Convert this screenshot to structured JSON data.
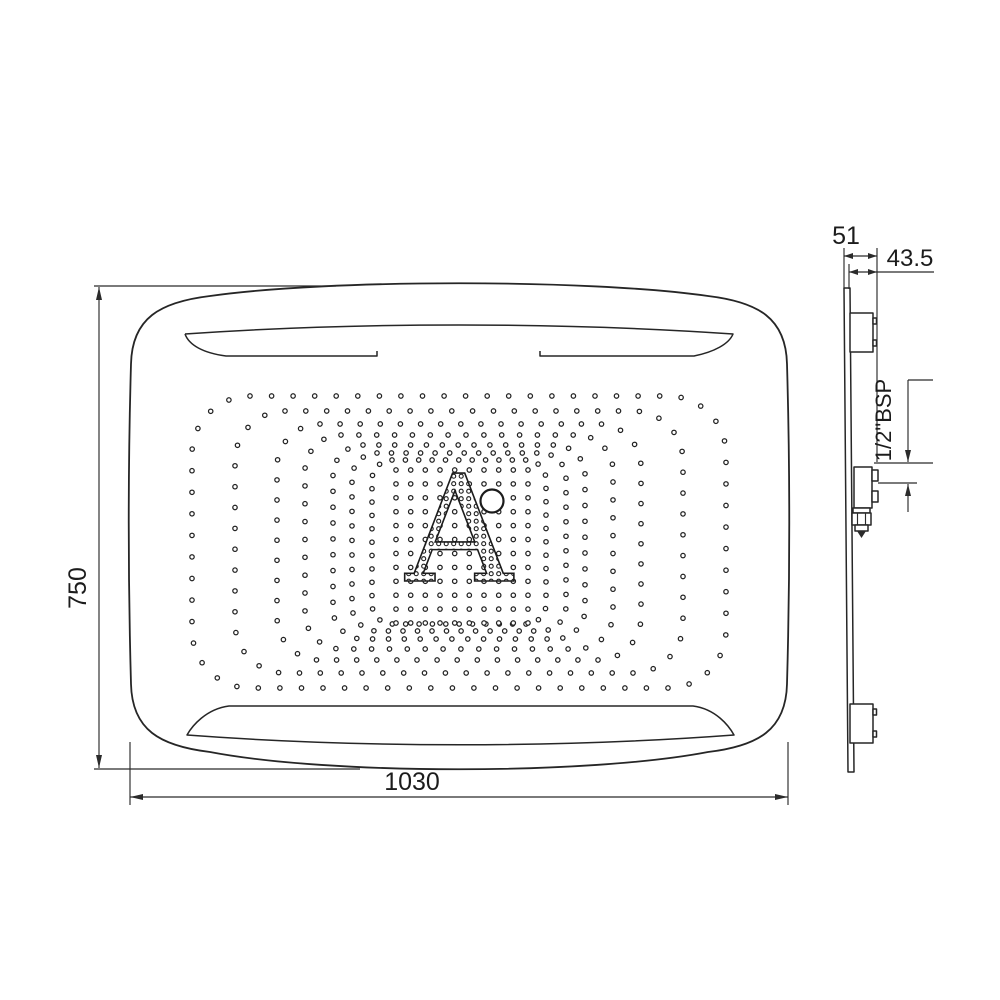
{
  "canvas": {
    "background": "#ffffff",
    "line_color": "#262626",
    "text_color": "#1c1c1c"
  },
  "front_view": {
    "height_label": "750",
    "width_label": "1030",
    "logo": {
      "letter": "A",
      "degree_mark": true
    },
    "nozzle_pattern": {
      "center": {
        "x": 459,
        "y": 542
      },
      "dot_radius": 2.2,
      "rings": [
        {
          "hw": 267,
          "hh": 146,
          "corner": 58,
          "spacing": 21.5
        },
        {
          "hw": 224,
          "hh": 131,
          "corner": 50,
          "spacing": 21
        },
        {
          "hw": 182,
          "hh": 118,
          "corner": 43,
          "spacing": 20
        },
        {
          "hw": 154,
          "hh": 107,
          "corner": 36,
          "spacing": 18
        },
        {
          "hw": 126,
          "hh": 97,
          "corner": 30,
          "spacing": 16
        },
        {
          "hw": 107,
          "hh": 89,
          "corner": 25,
          "spacing": 14.5
        },
        {
          "hw": 87,
          "hh": 82,
          "corner": 20,
          "spacing": 13.5
        }
      ],
      "grid": {
        "x0": 396,
        "x1": 528,
        "y0": 470,
        "y1": 623,
        "cols": 10,
        "rows": 12
      }
    }
  },
  "side_view": {
    "total_depth_label": "51",
    "face_depth_label": "43.5",
    "inlet_thread_label": "1/2\"BSP"
  }
}
